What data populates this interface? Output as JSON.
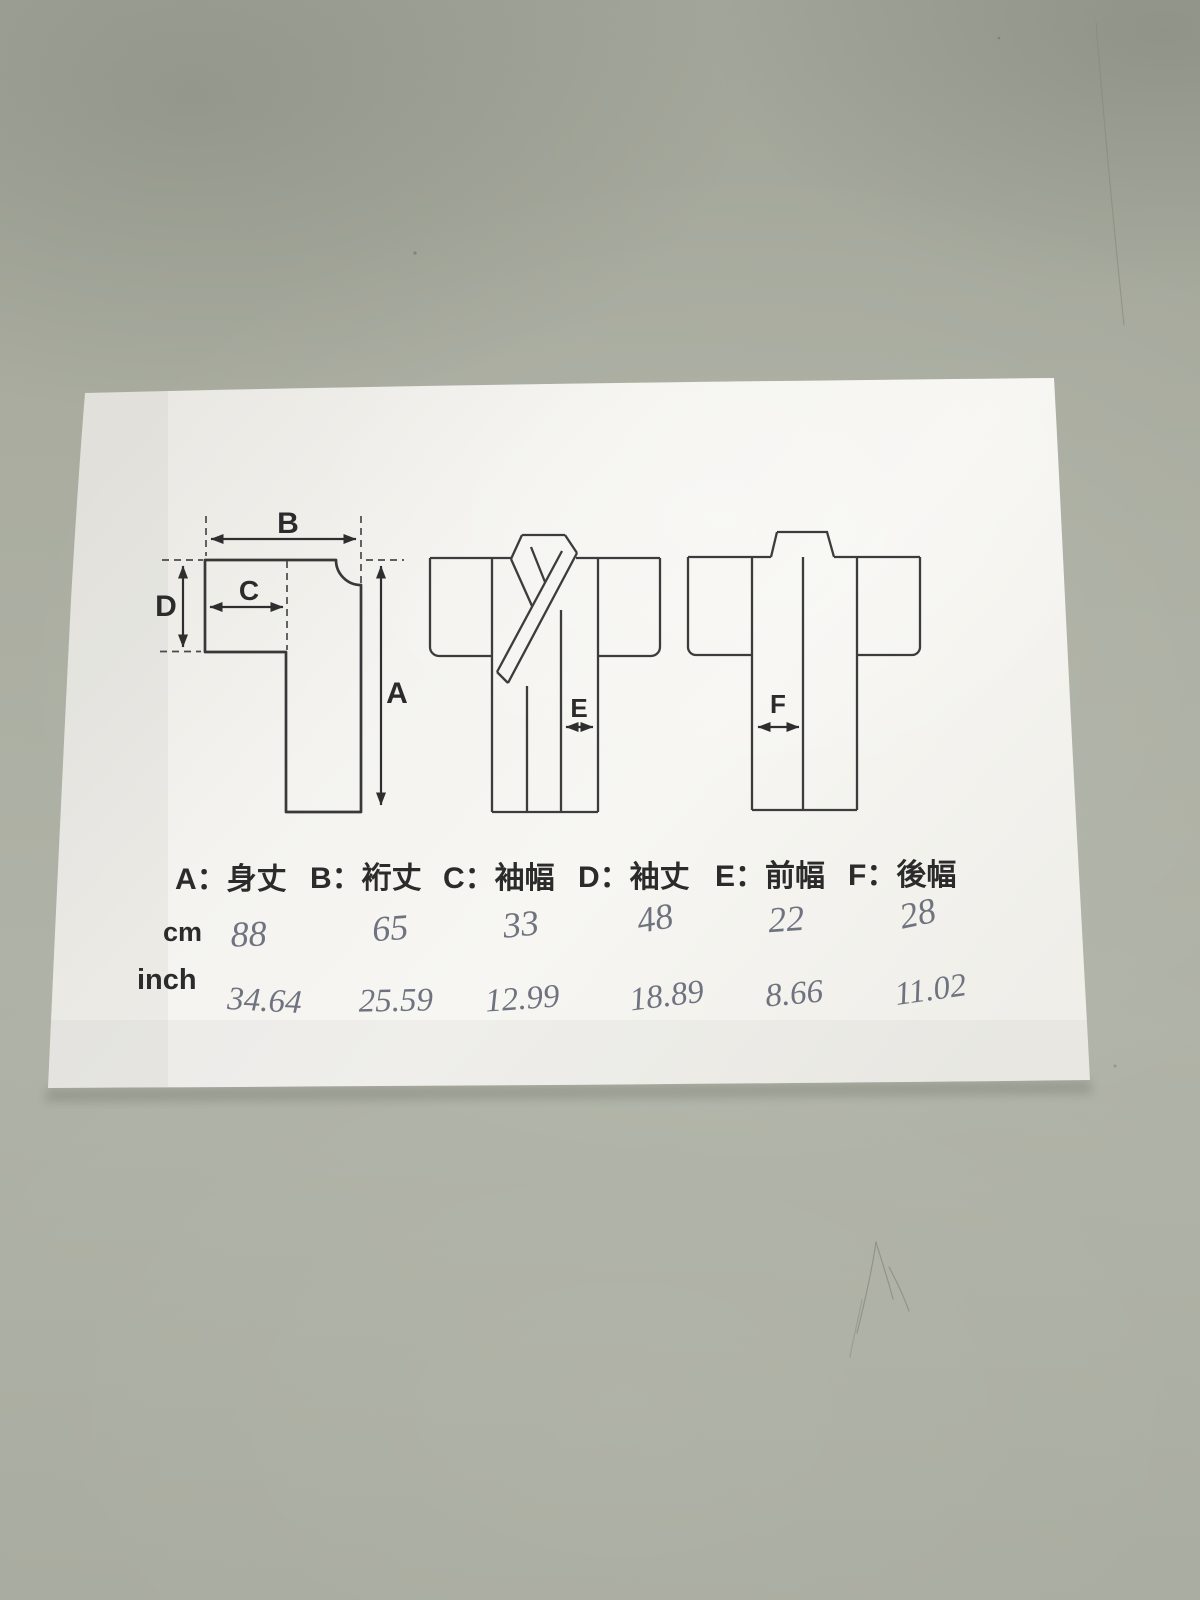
{
  "paper": {
    "legend": {
      "items": [
        {
          "id": "A",
          "text": "A：身丈"
        },
        {
          "id": "B",
          "text": "B：裄丈"
        },
        {
          "id": "C",
          "text": "C：袖幅"
        },
        {
          "id": "D",
          "text": "D：袖丈"
        },
        {
          "id": "E",
          "text": "E：前幅"
        },
        {
          "id": "F",
          "text": "F：後幅"
        }
      ]
    },
    "rows": {
      "cm": {
        "label": "cm",
        "values": [
          "88",
          "65",
          "33",
          "48",
          "22",
          "28"
        ]
      },
      "inch": {
        "label": "inch",
        "values": [
          "34.64",
          "25.59",
          "12.99",
          "18.89",
          "8.66",
          "11.02"
        ]
      }
    },
    "diagram_letters": {
      "A": "A",
      "B": "B",
      "C": "C",
      "D": "D",
      "E": "E",
      "F": "F"
    }
  },
  "colors": {
    "table_surface": "#a9ac9f",
    "paper": "#f4f3ef",
    "print_ink": "#2b2b2b",
    "diagram_line": "#383838",
    "handwriting_ink": "#6f7380"
  }
}
